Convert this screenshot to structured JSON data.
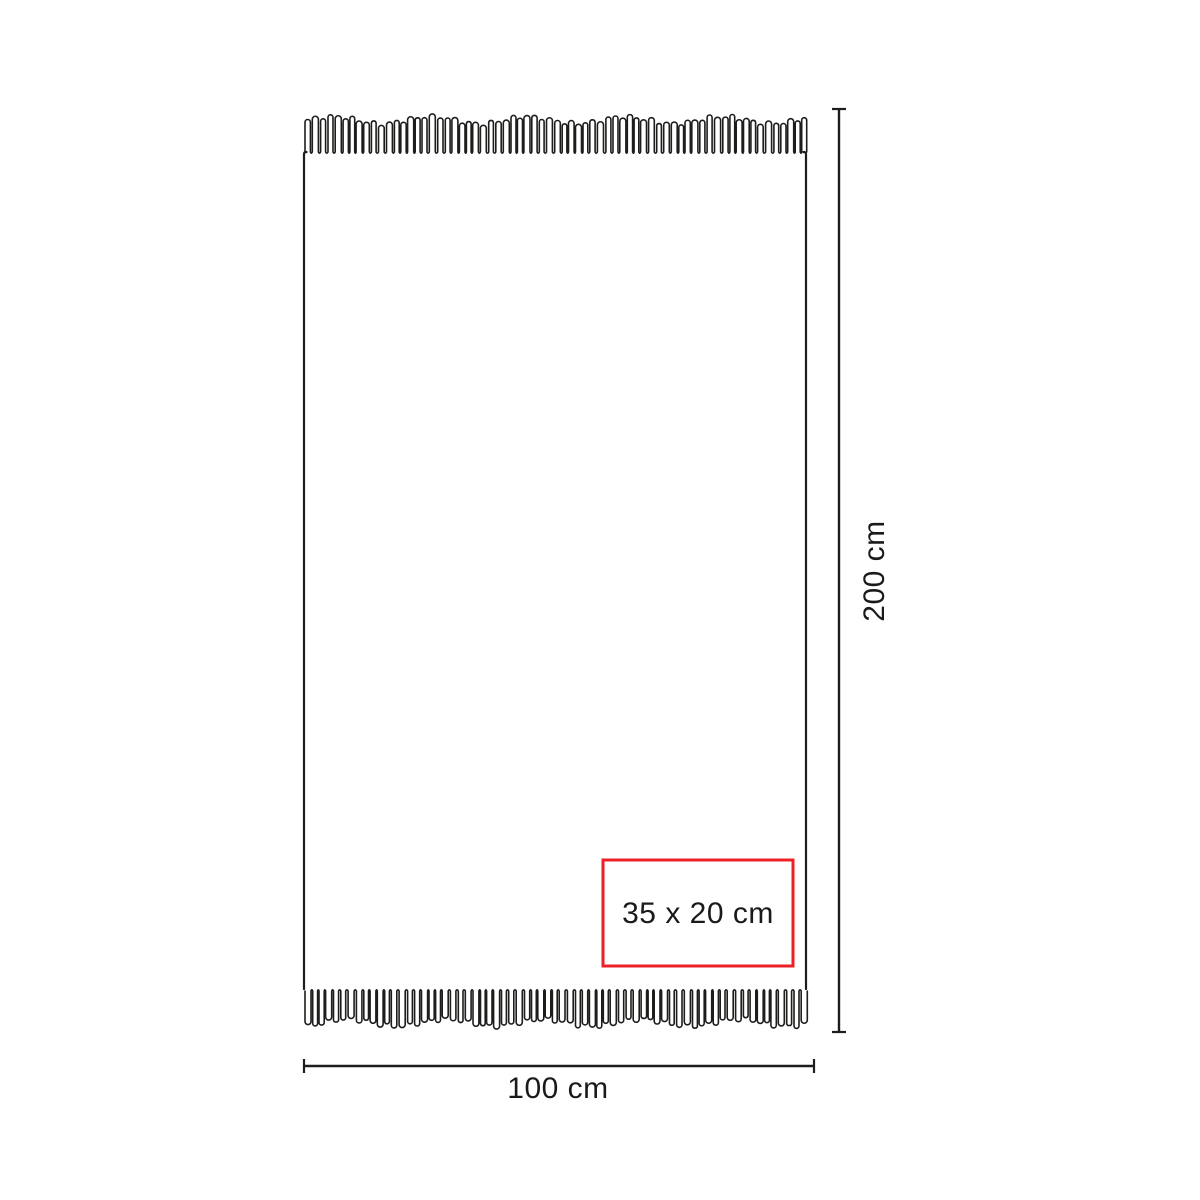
{
  "diagram": {
    "height_label": "200 cm",
    "width_label": "100 cm",
    "print_area_label": "35 x 20 cm"
  },
  "colors": {
    "outline": "#1d1d1b",
    "dimension": "#1d1d1b",
    "label_text": "#1a1a1a",
    "print_area_border": "#ec2127",
    "background": "#ffffff"
  }
}
